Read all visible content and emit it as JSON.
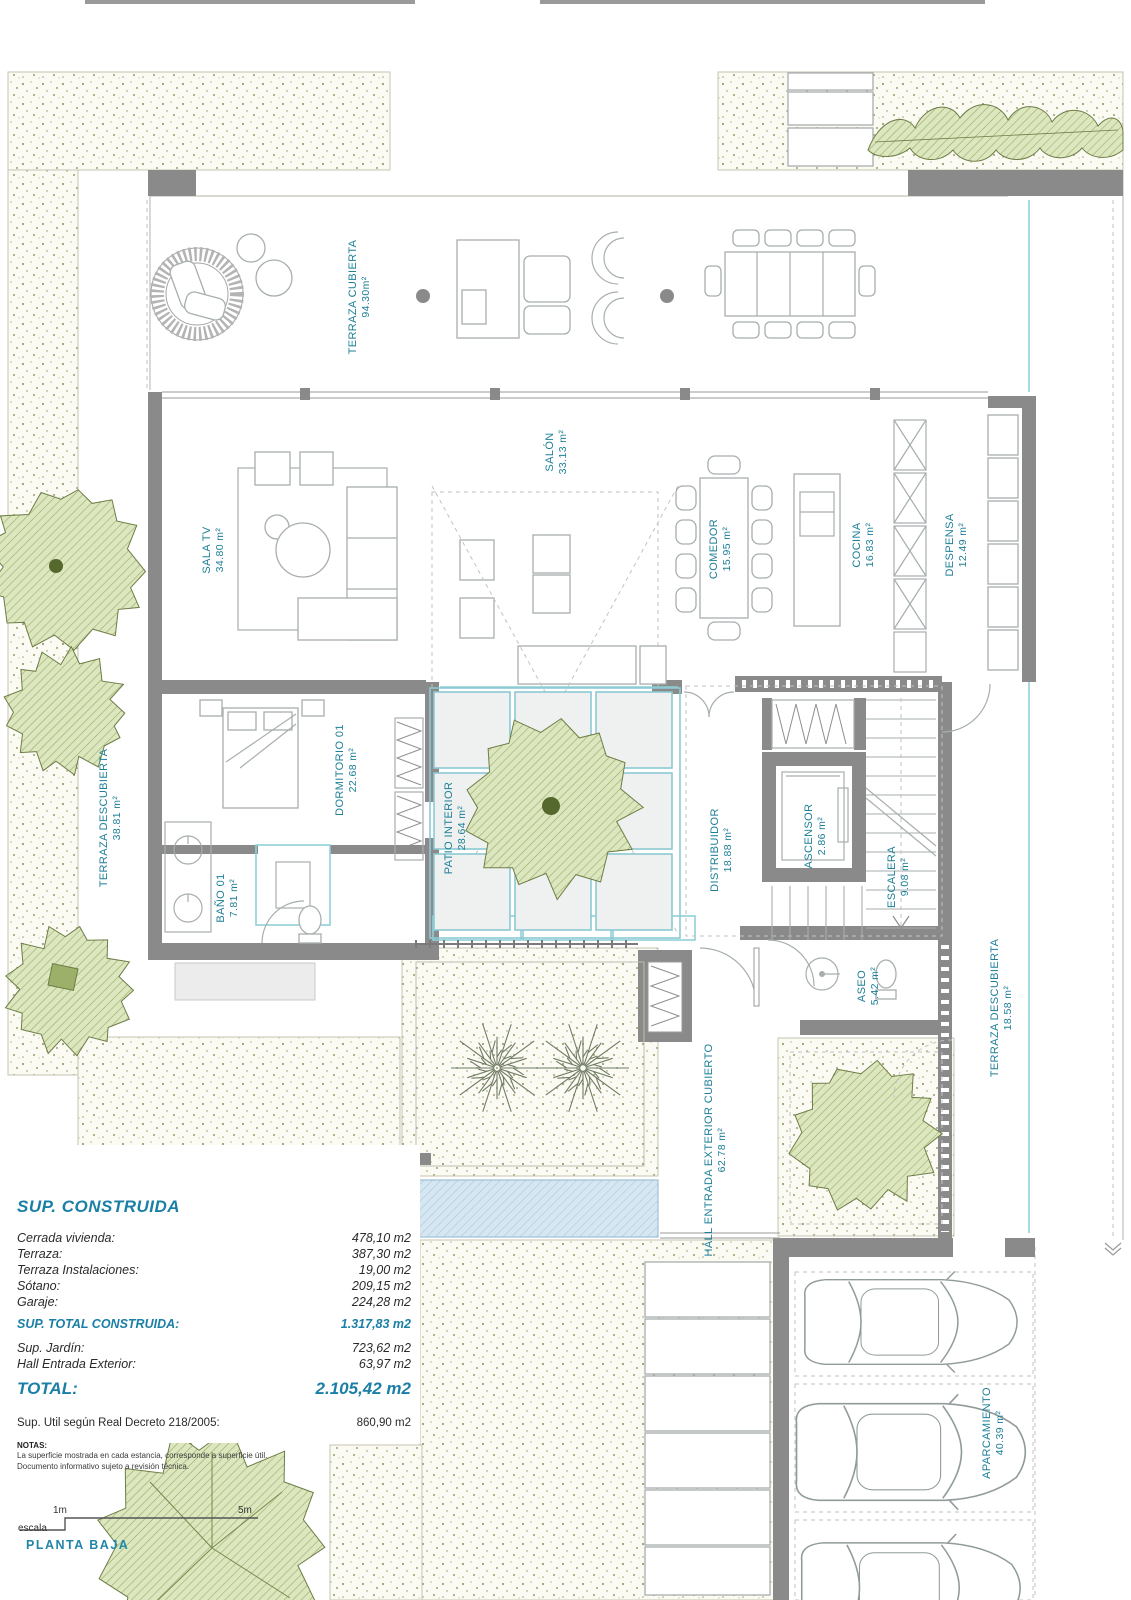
{
  "plan": {
    "name": "PLANTA BAJA",
    "scale": {
      "label": "escala",
      "tick1": "1m",
      "tick5": "5m"
    }
  },
  "rooms": {
    "terraza_cubierta": {
      "name": "TERRAZA CUBIERTA",
      "area": "94.30m²"
    },
    "sala_tv": {
      "name": "SALA TV",
      "area": "34.80 m²"
    },
    "salon": {
      "name": "SALÓN",
      "area": "33.13 m²"
    },
    "comedor": {
      "name": "COMEDOR",
      "area": "15.95 m²"
    },
    "cocina": {
      "name": "COCINA",
      "area": "16.83 m²"
    },
    "despensa": {
      "name": "DESPENSA",
      "area": "12.49 m²"
    },
    "terraza_descubierta_oeste": {
      "name": "TERRAZA DESCUBIERTA",
      "area": "38.81 m²"
    },
    "dormitorio_01": {
      "name": "DORMITORIO 01",
      "area": "22.68 m²"
    },
    "bano_01": {
      "name": "BAÑO 01",
      "area": "7.81 m²"
    },
    "patio_interior": {
      "name": "PATIO INTERIOR",
      "area": "28.64 m²"
    },
    "distribuidor": {
      "name": "DISTRIBUIDOR",
      "area": "18.88 m²"
    },
    "ascensor": {
      "name": "ASCENSOR",
      "area": "2.86 m²"
    },
    "escalera": {
      "name": "ESCALERA",
      "area": "9.08 m²"
    },
    "aseo": {
      "name": "ASEO",
      "area": "5.42 m²"
    },
    "terraza_descubierta_este": {
      "name": "TERRAZA DESCUBIERTA",
      "area": "18.58 m²"
    },
    "hall_entrada": {
      "name": "HALL ENTRADA EXTERIOR CUBIERTO",
      "area": "62.78 m²"
    },
    "aparcamiento": {
      "name": "APARCAMIENTO",
      "area": "40.39 m²"
    }
  },
  "summary": {
    "heading": "SUP. CONSTRUIDA",
    "rows": [
      {
        "label": "Cerrada vivienda:",
        "value": "478,10 m2"
      },
      {
        "label": "Terraza:",
        "value": "387,30 m2"
      },
      {
        "label": "Terraza Instalaciones:",
        "value": "19,00 m2"
      },
      {
        "label": "Sótano:",
        "value": "209,15 m2"
      },
      {
        "label": "Garaje:",
        "value": "224,28 m2"
      }
    ],
    "total_construida": {
      "label": "SUP.  TOTAL CONSTRUIDA:",
      "value": "1.317,83 m2"
    },
    "extra_rows": [
      {
        "label": "Sup. Jardín:",
        "value": "723,62 m2"
      },
      {
        "label": "Hall Entrada Exterior:",
        "value": "63,97 m2"
      }
    ],
    "total": {
      "label": "TOTAL:",
      "value": "2.105,42 m2"
    },
    "decreto": {
      "label": "Sup. Util según Real Decreto 218/2005:",
      "value": "860,90 m2"
    },
    "notas_heading": "NOTAS:",
    "notas": [
      "La superficie mostrada en cada estancia, corresponde a superficie útil.",
      "Documento informativo sujeto a revisión técnica."
    ]
  },
  "colors": {
    "label_teal": "#1d7f97",
    "summary_teal": "#1a7fa6",
    "wall_gray": "#8a8a8a",
    "tree_fill": "#dce6bf",
    "tree_hatch": "#9aad66",
    "pool_fill": "#d6e7f2",
    "stipple_dot": "#9e9e72"
  }
}
